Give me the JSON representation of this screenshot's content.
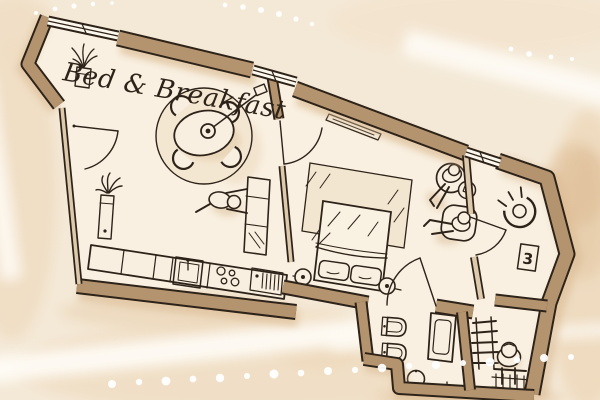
{
  "illustration": {
    "title": "Bed & Breakfast",
    "room_label": "3",
    "style": "hand-drawn watercolor floor plan",
    "colors": {
      "background": "#f4e9d7",
      "floor": "#f9f0e1",
      "wall": "#b4946f",
      "ink": "#2e2319",
      "wash_light": "#efdbc0",
      "wash_deep": "#dbb88f",
      "highlight": "#ffffff"
    },
    "objects": [
      "dining-table",
      "chairs",
      "pendant-lamp",
      "round-rug",
      "potted-plants",
      "kitchen-counter",
      "sink",
      "stove",
      "oven",
      "kitchen-island",
      "bed",
      "pillows",
      "nightstand-lamps",
      "bedroom-rug",
      "wall-shelf",
      "lounge-chairs",
      "side-table",
      "people-figures",
      "toilet",
      "bidet",
      "shower",
      "pedestal-sink",
      "towel-ladder",
      "floor-grid",
      "door-arcs",
      "windows"
    ]
  }
}
